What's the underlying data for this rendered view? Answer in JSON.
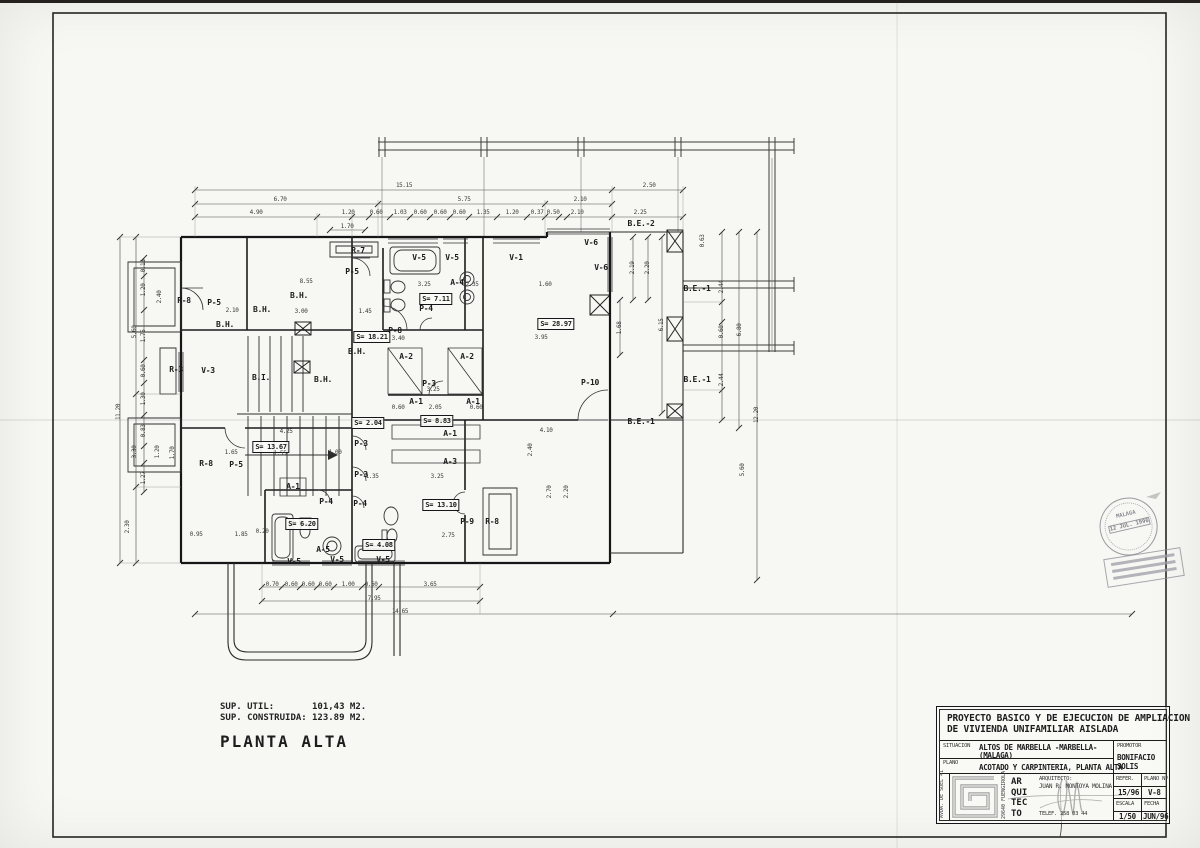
{
  "plan": {
    "summary": {
      "sup_util_label": "SUP. UTIL:",
      "sup_util_value": "101,43 M2.",
      "sup_cons_label": "SUP. CONSTRUIDA:",
      "sup_cons_value": "123.89 M2.",
      "floor_title": "PLANTA ALTA"
    },
    "labels": [
      {
        "t": "R-7",
        "x": 358,
        "y": 251
      },
      {
        "t": "P-5",
        "x": 352,
        "y": 272
      },
      {
        "t": "R-8",
        "x": 184,
        "y": 301
      },
      {
        "t": "P-5",
        "x": 214,
        "y": 303
      },
      {
        "t": "B.H.",
        "x": 299,
        "y": 296
      },
      {
        "t": "B.H.",
        "x": 262,
        "y": 310
      },
      {
        "t": "B.H.",
        "x": 225,
        "y": 325
      },
      {
        "t": "B.H.",
        "x": 357,
        "y": 352
      },
      {
        "t": "S= 18.21",
        "x": 372,
        "y": 337,
        "box": 1
      },
      {
        "t": "P-8",
        "x": 395,
        "y": 331
      },
      {
        "t": "B.I.",
        "x": 261,
        "y": 378
      },
      {
        "t": "B.H.",
        "x": 323,
        "y": 380
      },
      {
        "t": "R-3",
        "x": 176,
        "y": 370
      },
      {
        "t": "V-3",
        "x": 208,
        "y": 371
      },
      {
        "t": "V-5",
        "x": 419,
        "y": 258
      },
      {
        "t": "V-5",
        "x": 452,
        "y": 258
      },
      {
        "t": "A-4",
        "x": 457,
        "y": 283
      },
      {
        "t": "S= 7.11",
        "x": 436,
        "y": 299,
        "box": 1
      },
      {
        "t": "P-4",
        "x": 426,
        "y": 309
      },
      {
        "t": "V-1",
        "x": 516,
        "y": 258
      },
      {
        "t": "V-6",
        "x": 591,
        "y": 243
      },
      {
        "t": "V-6",
        "x": 601,
        "y": 268
      },
      {
        "t": "B.E.-2",
        "x": 641,
        "y": 224
      },
      {
        "t": "S= 28.97",
        "x": 556,
        "y": 324,
        "box": 1
      },
      {
        "t": "B.E.-1",
        "x": 697,
        "y": 289
      },
      {
        "t": "B.E.-1",
        "x": 697,
        "y": 380
      },
      {
        "t": "B.E.-1",
        "x": 641,
        "y": 422
      },
      {
        "t": "P-10",
        "x": 590,
        "y": 383
      },
      {
        "t": "A-2",
        "x": 406,
        "y": 357
      },
      {
        "t": "A-2",
        "x": 467,
        "y": 357
      },
      {
        "t": "P-3",
        "x": 429,
        "y": 384
      },
      {
        "t": "A-1",
        "x": 416,
        "y": 402
      },
      {
        "t": "A-1",
        "x": 473,
        "y": 402
      },
      {
        "t": "S= 2.04",
        "x": 368,
        "y": 423,
        "box": 1
      },
      {
        "t": "S= 8.83",
        "x": 437,
        "y": 421,
        "box": 1
      },
      {
        "t": "A-1",
        "x": 450,
        "y": 434
      },
      {
        "t": "A-3",
        "x": 450,
        "y": 462
      },
      {
        "t": "P-3",
        "x": 361,
        "y": 444
      },
      {
        "t": "P-3",
        "x": 361,
        "y": 475
      },
      {
        "t": "S= 13.67",
        "x": 271,
        "y": 447,
        "box": 1
      },
      {
        "t": "R-8",
        "x": 206,
        "y": 464
      },
      {
        "t": "P-5",
        "x": 236,
        "y": 465
      },
      {
        "t": "A-1",
        "x": 293,
        "y": 487
      },
      {
        "t": "P-4",
        "x": 326,
        "y": 502
      },
      {
        "t": "P-4",
        "x": 360,
        "y": 504
      },
      {
        "t": "S= 6.20",
        "x": 302,
        "y": 524,
        "box": 1
      },
      {
        "t": "S= 13.10",
        "x": 441,
        "y": 505,
        "box": 1
      },
      {
        "t": "P-9",
        "x": 467,
        "y": 522
      },
      {
        "t": "R-8",
        "x": 492,
        "y": 522
      },
      {
        "t": "A-5",
        "x": 323,
        "y": 550
      },
      {
        "t": "V-5",
        "x": 294,
        "y": 562
      },
      {
        "t": "V-5",
        "x": 337,
        "y": 560
      },
      {
        "t": "V-5",
        "x": 383,
        "y": 560
      },
      {
        "t": "S= 4.08",
        "x": 379,
        "y": 545,
        "box": 1
      }
    ],
    "dims": [
      {
        "t": "15.15",
        "x": 404,
        "y": 186
      },
      {
        "t": "2.50",
        "x": 649,
        "y": 186
      },
      {
        "t": "6.70",
        "x": 280,
        "y": 200
      },
      {
        "t": "5.75",
        "x": 464,
        "y": 200
      },
      {
        "t": "2.10",
        "x": 580,
        "y": 200
      },
      {
        "t": "4.90",
        "x": 256,
        "y": 213
      },
      {
        "t": "1.20",
        "x": 348,
        "y": 213
      },
      {
        "t": "0.60",
        "x": 376,
        "y": 213
      },
      {
        "t": "1.03",
        "x": 400,
        "y": 213
      },
      {
        "t": "0.60",
        "x": 420,
        "y": 213
      },
      {
        "t": "0.60",
        "x": 440,
        "y": 213
      },
      {
        "t": "0.60",
        "x": 459,
        "y": 213
      },
      {
        "t": "1.35",
        "x": 483,
        "y": 213
      },
      {
        "t": "1.20",
        "x": 512,
        "y": 213
      },
      {
        "t": "0.37",
        "x": 537,
        "y": 213
      },
      {
        "t": "0.50",
        "x": 553,
        "y": 213
      },
      {
        "t": "2.10",
        "x": 577,
        "y": 213
      },
      {
        "t": "2.25",
        "x": 640,
        "y": 213
      },
      {
        "t": "1.70",
        "x": 347,
        "y": 227
      },
      {
        "t": "11.20",
        "x": 119,
        "y": 412,
        "r": 1
      },
      {
        "t": "5.60",
        "x": 135,
        "y": 332,
        "r": 1
      },
      {
        "t": "3.30",
        "x": 135,
        "y": 452,
        "r": 1
      },
      {
        "t": "2.30",
        "x": 128,
        "y": 527,
        "r": 1
      },
      {
        "t": "0.15",
        "x": 144,
        "y": 266,
        "r": 1
      },
      {
        "t": "1.20",
        "x": 144,
        "y": 290,
        "r": 1
      },
      {
        "t": "2.40",
        "x": 160,
        "y": 297,
        "r": 1
      },
      {
        "t": "1.75",
        "x": 144,
        "y": 336,
        "r": 1
      },
      {
        "t": "0.60",
        "x": 144,
        "y": 371,
        "r": 1
      },
      {
        "t": "1.30",
        "x": 144,
        "y": 399,
        "r": 1
      },
      {
        "t": "0.83",
        "x": 144,
        "y": 431,
        "r": 1
      },
      {
        "t": "1.20",
        "x": 158,
        "y": 452,
        "r": 1
      },
      {
        "t": "1.27",
        "x": 144,
        "y": 478,
        "r": 1
      },
      {
        "t": "1.70",
        "x": 173,
        "y": 453,
        "r": 1
      },
      {
        "t": "0.63",
        "x": 703,
        "y": 241,
        "r": 1
      },
      {
        "t": "2.44",
        "x": 722,
        "y": 287,
        "r": 1
      },
      {
        "t": "0.60",
        "x": 722,
        "y": 332,
        "r": 1
      },
      {
        "t": "2.44",
        "x": 722,
        "y": 380,
        "r": 1
      },
      {
        "t": "6.80",
        "x": 740,
        "y": 330,
        "r": 1
      },
      {
        "t": "12.20",
        "x": 757,
        "y": 415,
        "r": 1
      },
      {
        "t": "5.60",
        "x": 743,
        "y": 470,
        "r": 1
      },
      {
        "t": "2.19",
        "x": 633,
        "y": 268,
        "r": 1
      },
      {
        "t": "2.20",
        "x": 648,
        "y": 268,
        "r": 1
      },
      {
        "t": "6.15",
        "x": 662,
        "y": 325,
        "r": 1
      },
      {
        "t": "1.68",
        "x": 620,
        "y": 328,
        "r": 1
      },
      {
        "t": "0.70",
        "x": 272,
        "y": 585
      },
      {
        "t": "0.60",
        "x": 291,
        "y": 585
      },
      {
        "t": "0.60",
        "x": 308,
        "y": 585
      },
      {
        "t": "0.60",
        "x": 325,
        "y": 585
      },
      {
        "t": "1.00",
        "x": 348,
        "y": 585
      },
      {
        "t": "0.60",
        "x": 371,
        "y": 585
      },
      {
        "t": "3.65",
        "x": 430,
        "y": 585
      },
      {
        "t": "7.95",
        "x": 374,
        "y": 599
      },
      {
        "t": "14.65",
        "x": 400,
        "y": 612
      },
      {
        "t": "8.55",
        "x": 306,
        "y": 282
      },
      {
        "t": "2.10",
        "x": 232,
        "y": 311
      },
      {
        "t": "3.00",
        "x": 301,
        "y": 312
      },
      {
        "t": "1.45",
        "x": 365,
        "y": 312
      },
      {
        "t": "3.25",
        "x": 424,
        "y": 285
      },
      {
        "t": "2.35",
        "x": 472,
        "y": 285
      },
      {
        "t": "1.60",
        "x": 545,
        "y": 285
      },
      {
        "t": "3.40",
        "x": 398,
        "y": 339
      },
      {
        "t": "3.95",
        "x": 541,
        "y": 338
      },
      {
        "t": "3.25",
        "x": 433,
        "y": 390
      },
      {
        "t": "2.05",
        "x": 435,
        "y": 408
      },
      {
        "t": "0.60",
        "x": 398,
        "y": 408
      },
      {
        "t": "0.60",
        "x": 476,
        "y": 408
      },
      {
        "t": "1.35",
        "x": 372,
        "y": 477
      },
      {
        "t": "3.25",
        "x": 437,
        "y": 477
      },
      {
        "t": "2.75",
        "x": 448,
        "y": 536
      },
      {
        "t": "4.10",
        "x": 546,
        "y": 431
      },
      {
        "t": "2.40",
        "x": 531,
        "y": 450,
        "r": 1
      },
      {
        "t": "2.70",
        "x": 550,
        "y": 492,
        "r": 1
      },
      {
        "t": "2.20",
        "x": 567,
        "y": 492,
        "r": 1
      },
      {
        "t": "4.25",
        "x": 286,
        "y": 432
      },
      {
        "t": "1.65",
        "x": 231,
        "y": 453
      },
      {
        "t": "1.55",
        "x": 280,
        "y": 454
      },
      {
        "t": "1.00",
        "x": 335,
        "y": 453
      },
      {
        "t": "0.95",
        "x": 196,
        "y": 535
      },
      {
        "t": "1.85",
        "x": 241,
        "y": 535
      },
      {
        "t": "0.20",
        "x": 262,
        "y": 532
      }
    ]
  },
  "title_block": {
    "project_title_line1": "PROYECTO BASICO Y DE EJECUCION DE AMPLIACION",
    "project_title_line2": "DE VIVIENDA UNIFAMILIAR AISLADA",
    "situacion_label": "SITUACION",
    "situacion_value1": "ALTOS DE MARBELLA -MARBELLA-",
    "situacion_value2": "(MALAGA)",
    "plano_label": "PLANO",
    "plano_value": "ACOTADO Y CARPINTERIA, PLANTA ALTA",
    "promotor_label": "PROMOTOR",
    "promotor_value": "BONIFACIO SOLIS",
    "address_vertical": "AVDA. DE SUEL 41",
    "postal_vertical": "29640 FUENGIROLA",
    "arq_l1": "AR",
    "arq_l2": "QUI",
    "arq_l3": "TEC",
    "arq_l4": "TO",
    "arquitecto_label": "ARQUITECTO:",
    "arquitecto_value": "JUAN R. MONTOYA MOLINA",
    "telef": "TELEF. 258 03 44",
    "refer_label": "REFER.",
    "refer_value": "15/96",
    "plano_num_label": "PLANO Nº",
    "plano_num_value": "V-8",
    "escala_label": "ESCALA",
    "escala_value": "1/50",
    "fecha_label": "FECHA",
    "fecha_value": "JUN/96"
  },
  "stamp": {
    "city": "MALAGA",
    "date": "12 JUL. 1996"
  }
}
